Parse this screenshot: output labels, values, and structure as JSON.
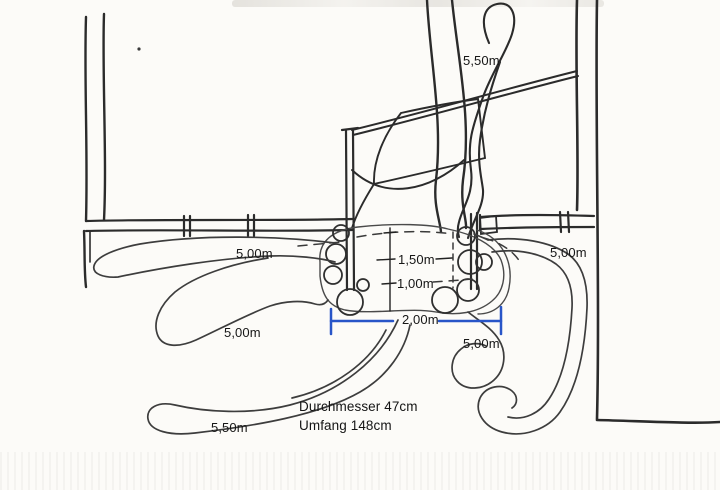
{
  "sketch": {
    "annotations": {
      "branch_top": "5,50m",
      "root_left_upper": "5,00m",
      "root_left_middle": "5,00m",
      "root_left_lower": "5,50m",
      "root_right_upper": "5,00m",
      "root_right_lower": "5,00m"
    },
    "dimensions": {
      "offset_upper": "1,50m",
      "offset_lower": "1,00m",
      "width_between": "2,00m"
    },
    "notes": {
      "line1": "Durchmesser 47cm",
      "line2": "Umfang 148cm"
    },
    "colors": {
      "ink": "#2b2b2b",
      "root_ink": "#3d3d3d",
      "dimension_blue": "#2855c8",
      "paper": "#fcfbf8"
    }
  }
}
